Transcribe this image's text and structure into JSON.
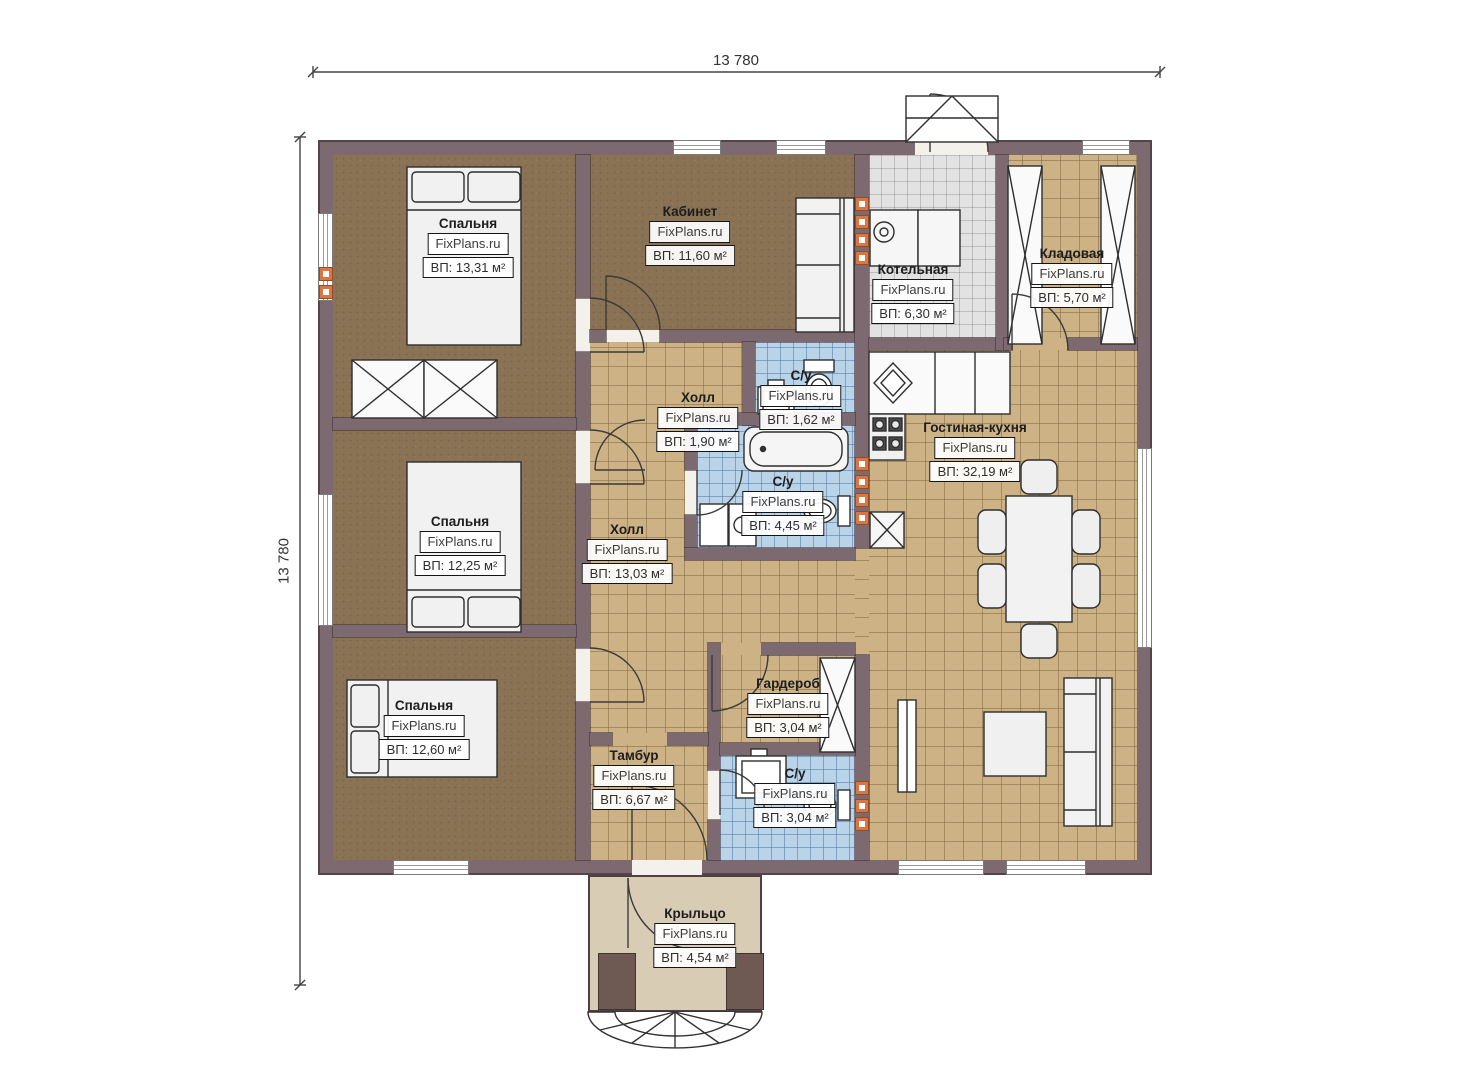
{
  "plan": {
    "brand": "FixPlans.ru",
    "dimensions": {
      "top": "13 780",
      "left": "13 780"
    },
    "colors": {
      "wall": "#7d6970",
      "floor_wood": "#8a7254",
      "floor_tile_tan": "#ccb285",
      "floor_tile_blue": "#b9d3e9",
      "floor_tile_gray": "#e2e2e2",
      "porch": "#d9ccb4",
      "vent_accent": "#dc7540"
    }
  },
  "rooms": [
    {
      "id": "bedroom-1",
      "label": "Спальня",
      "watermark": "FixPlans.ru",
      "area": "ВП: 13,31 м²"
    },
    {
      "id": "office",
      "label": "Кабинет",
      "watermark": "FixPlans.ru",
      "area": "ВП: 11,60 м²"
    },
    {
      "id": "boiler-room",
      "label": "Котельная",
      "watermark": "FixPlans.ru",
      "area": "ВП: 6,30 м²"
    },
    {
      "id": "storage",
      "label": "Кладовая",
      "watermark": "FixPlans.ru",
      "area": "ВП: 5,70 м²"
    },
    {
      "id": "hall-small",
      "label": "Холл",
      "watermark": "FixPlans.ru",
      "area": "ВП: 1,90 м²"
    },
    {
      "id": "wc-top",
      "label": "С/у",
      "watermark": "FixPlans.ru",
      "area": "ВП: 1,62 м²"
    },
    {
      "id": "wc-main",
      "label": "С/у",
      "watermark": "FixPlans.ru",
      "area": "ВП: 4,45 м²"
    },
    {
      "id": "living-kitchen",
      "label": "Гостиная-кухня",
      "watermark": "FixPlans.ru",
      "area": "ВП: 32,19 м²"
    },
    {
      "id": "hall-main",
      "label": "Холл",
      "watermark": "FixPlans.ru",
      "area": "ВП: 13,03 м²"
    },
    {
      "id": "bedroom-2",
      "label": "Спальня",
      "watermark": "FixPlans.ru",
      "area": "ВП: 12,25 м²"
    },
    {
      "id": "bedroom-3",
      "label": "Спальня",
      "watermark": "FixPlans.ru",
      "area": "ВП: 12,60 м²"
    },
    {
      "id": "wardrobe",
      "label": "Гардероб",
      "watermark": "FixPlans.ru",
      "area": "ВП: 3,04 м²"
    },
    {
      "id": "vestibule",
      "label": "Тамбур",
      "watermark": "FixPlans.ru",
      "area": "ВП: 6,67 м²"
    },
    {
      "id": "wc-bottom",
      "label": "С/у",
      "watermark": "FixPlans.ru",
      "area": "ВП: 3,04 м²"
    },
    {
      "id": "porch",
      "label": "Крыльцо",
      "watermark": "FixPlans.ru",
      "area": "ВП: 4,54 м²"
    }
  ]
}
